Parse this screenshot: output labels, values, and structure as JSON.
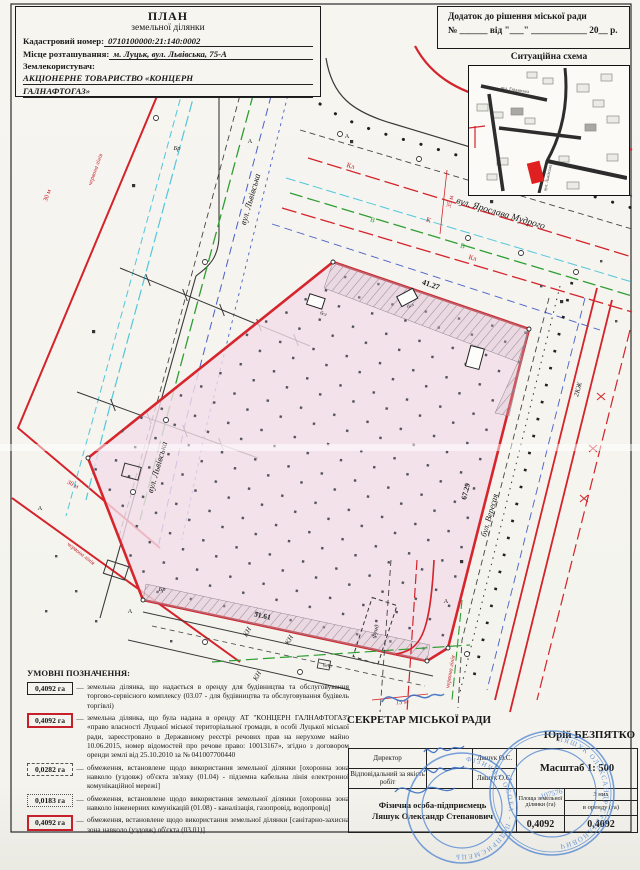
{
  "header": {
    "title": "ПЛАН",
    "subtitle": "земельної ділянки",
    "cadastral_label": "Кадастровий номер:",
    "cadastral_value": "0710100000:21:140:0002",
    "location_label": "Місце розташування:",
    "location_value": "м. Луцьк, вул. Львівська, 75-А",
    "user_label": "Землекористувач:",
    "user_value_line1": "АКЦІОНЕРНЕ ТОВАРИСТВО «КОНЦЕРН",
    "user_value_line2": "ГАЛНАФТОГАЗ»"
  },
  "annex": {
    "line1": "Додаток до рішення  міської ради",
    "line2": "№ ______ від \"___\" ____________ 20__ р."
  },
  "scheme": {
    "title": "Ситуаційна схема",
    "streets": {
      "top": "вул. Гнідавська",
      "main": "вул. Ярослава Мудрого",
      "left": "вул. Львівська"
    }
  },
  "plan": {
    "streets": {
      "lvivska": "вул. Львівська",
      "mudrogo": "вул. Ярослава Мудрого",
      "veresaya": "бул. Вересая"
    },
    "dims": {
      "top": "41.27",
      "right": "67.29",
      "bottom": "51.61",
      "d30": "30 м",
      "d35": "35 м",
      "d15": "15 м"
    },
    "labels": {
      "red_line": "червона лінія",
      "kzh": "2КЖ",
      "kn": "КН",
      "br": "Бр",
      "a": "А",
      "fund": "фунд",
      "bet": "бет",
      "k": "К",
      "kl": "Кл",
      "v": "В",
      "bsl": "бсл"
    }
  },
  "legend": {
    "title": "УМОВНІ ПОЗНАЧЕННЯ:",
    "items": [
      {
        "value": "0,4092 га",
        "text": "земельна ділянка, що надається в оренду для будівництва та обслуговування торгово-сервісного комплексу (03.07 - для будівництва та обслуговування будівель торгівлі)"
      },
      {
        "value": "0,4092 га",
        "text": "земельна ділянка, що була надана в оренду АТ \"КОНЦЕРН ГАЛНАФТОГАЗ\" «право власності Луцької міської територіальної громади, в особі Луцької міської ради, зареєстровано в Державному реєстрі речових прав на нерухоме майно 10.06.2015, номер відомостей про речове право: 10013167», згідно з договором оренди землі від 25.10.2010 за № 041007700440"
      },
      {
        "value": "0,0282 га",
        "text": "обмеження, встановлене щодо використання земельної ділянки [охоронна зона навколо (уздовж) об'єкта зв'язку (01.04) - підземна кабельна лінія електронної комунікаційної мережі]"
      },
      {
        "value": "0,0183 га",
        "text": "обмеження, встановлене щодо використання земельної ділянки [охоронна зона навколо інженерних комунікацій (01.08) - каналізація, газопровід, водопровід]"
      },
      {
        "value": "0,4092 га",
        "text": "обмеження, встановлене щодо використання земельної ділянки [санітарно-захисна зона навколо (уздовж) об'єкта (03.01)]"
      }
    ]
  },
  "approval": {
    "secretary_title": "СЕКРЕТАР МІСЬКОЇ РАДИ",
    "secretary_name": "Юрій БЕЗПЯТКО"
  },
  "table": {
    "row1_label": "Директор",
    "row1_name": "Ляшук О.С.",
    "row2_label": "Відповідальний за якість робіт",
    "row2_name": "Ляшук О.С.",
    "fop_line1": "Фізична особа-підприємець",
    "fop_line2": "Ляшук Олександр Степанович",
    "scale": "Масштаб  1: 500",
    "col_area": "Площа земельної ділянки (га)",
    "col_of_which": "З них",
    "col_lease": "в оренду (га)",
    "area_value": "0,4092",
    "lease_value": "0,4092"
  },
  "stamp": {
    "ring1": "ФІЗИЧНА ОСОБА - ПІДПРИЄМЕЦЬ",
    "ring2": "ЛЯШУК ОЛЕКСАНДР СТЕПАНОВИЧ",
    "number": "107576"
  }
}
